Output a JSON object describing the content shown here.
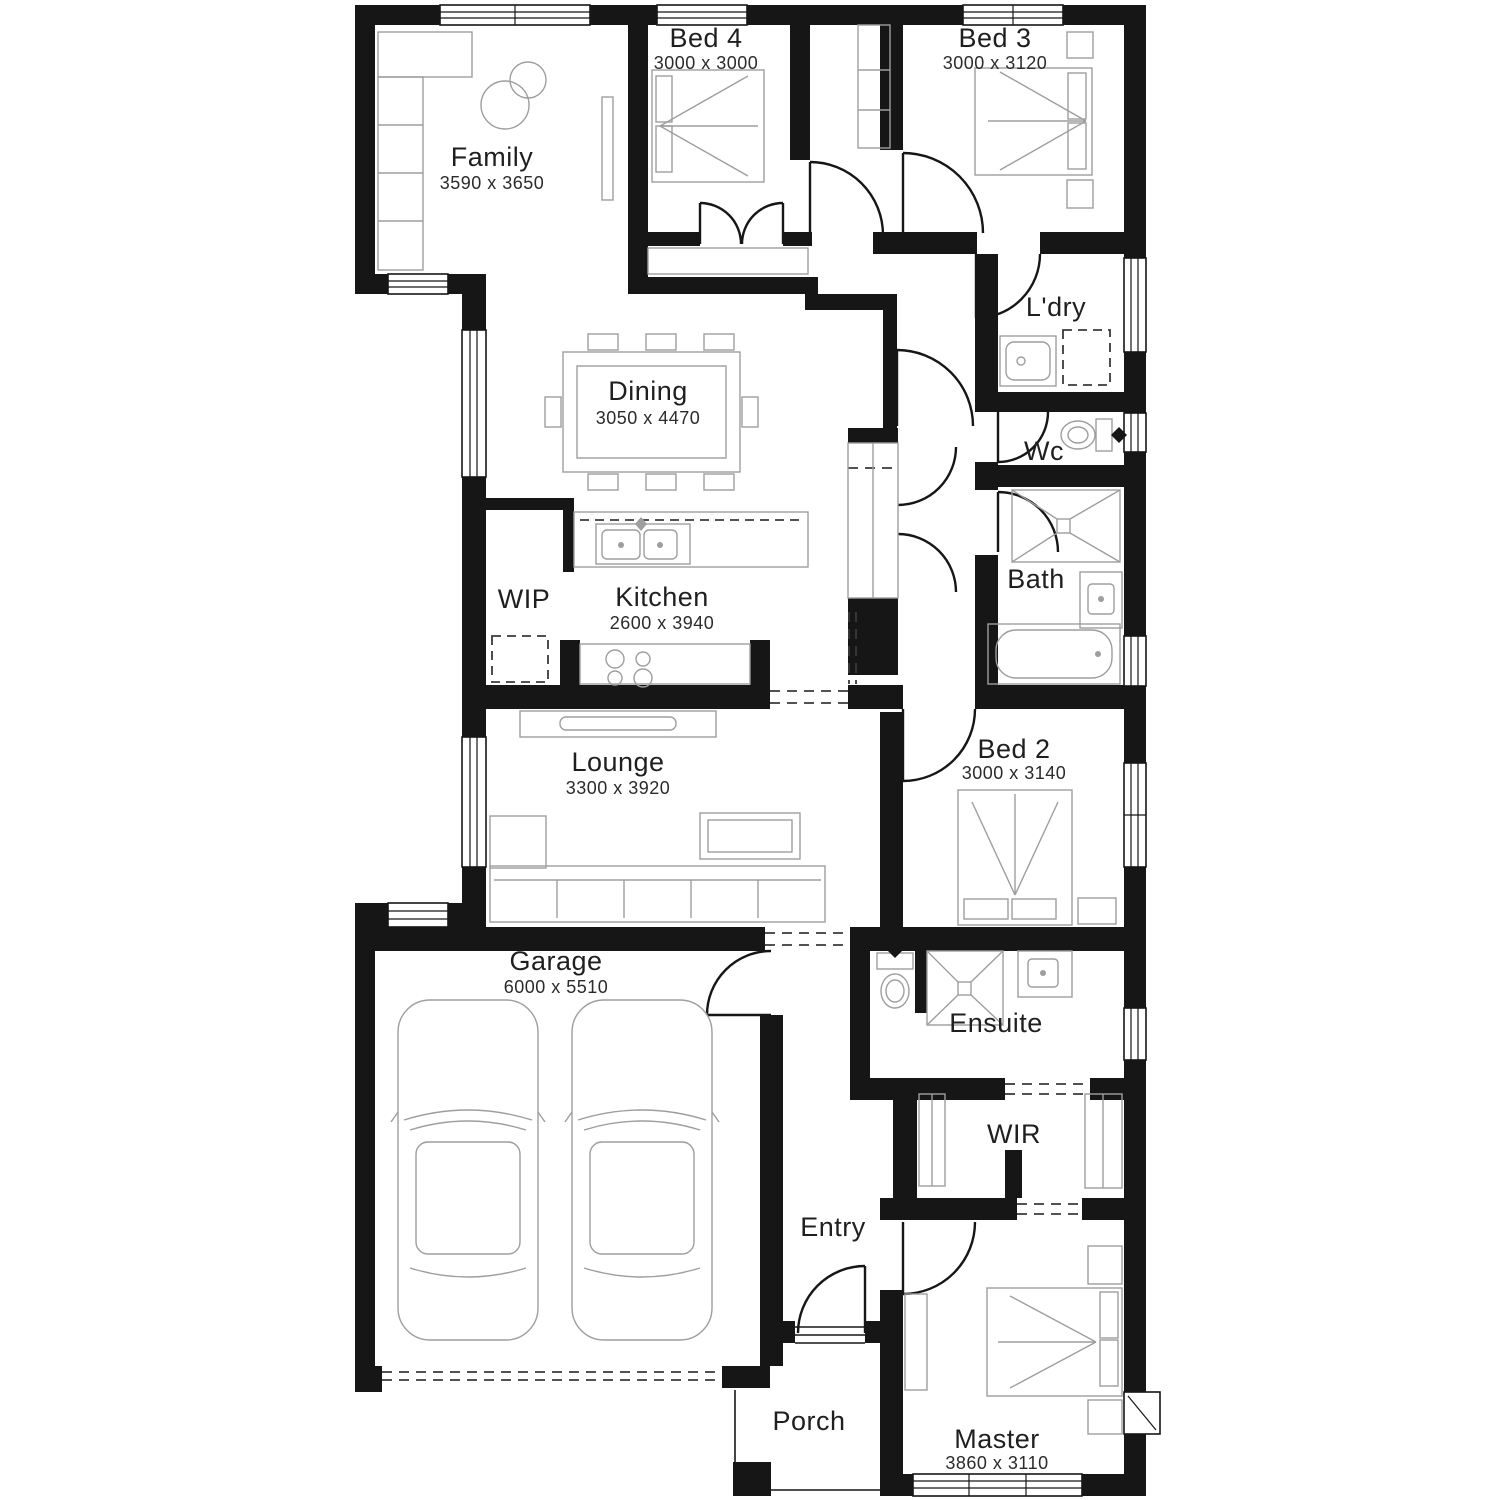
{
  "colors": {
    "wall": "#161616",
    "furniture_outline": "#9e9e9e",
    "label_text": "#1f1f1f",
    "background": "#ffffff"
  },
  "rooms": {
    "family": {
      "name": "Family",
      "dims": "3590 x 3650"
    },
    "bed4": {
      "name": "Bed 4",
      "dims": "3000 x 3000"
    },
    "bed3": {
      "name": "Bed 3",
      "dims": "3000 x 3120"
    },
    "ldry": {
      "name": "L'dry",
      "dims": ""
    },
    "dining": {
      "name": "Dining",
      "dims": "3050 x 4470"
    },
    "wc": {
      "name": "Wc",
      "dims": ""
    },
    "bath": {
      "name": "Bath",
      "dims": ""
    },
    "wip": {
      "name": "WIP",
      "dims": ""
    },
    "kitchen": {
      "name": "Kitchen",
      "dims": "2600 x 3940"
    },
    "lounge": {
      "name": "Lounge",
      "dims": "3300 x 3920"
    },
    "bed2": {
      "name": "Bed 2",
      "dims": "3000 x 3140"
    },
    "garage": {
      "name": "Garage",
      "dims": "6000 x 5510"
    },
    "ensuite": {
      "name": "Ensuite",
      "dims": ""
    },
    "wir": {
      "name": "WIR",
      "dims": ""
    },
    "entry": {
      "name": "Entry",
      "dims": ""
    },
    "porch": {
      "name": "Porch",
      "dims": ""
    },
    "master": {
      "name": "Master",
      "dims": "3860 x 3110"
    }
  }
}
